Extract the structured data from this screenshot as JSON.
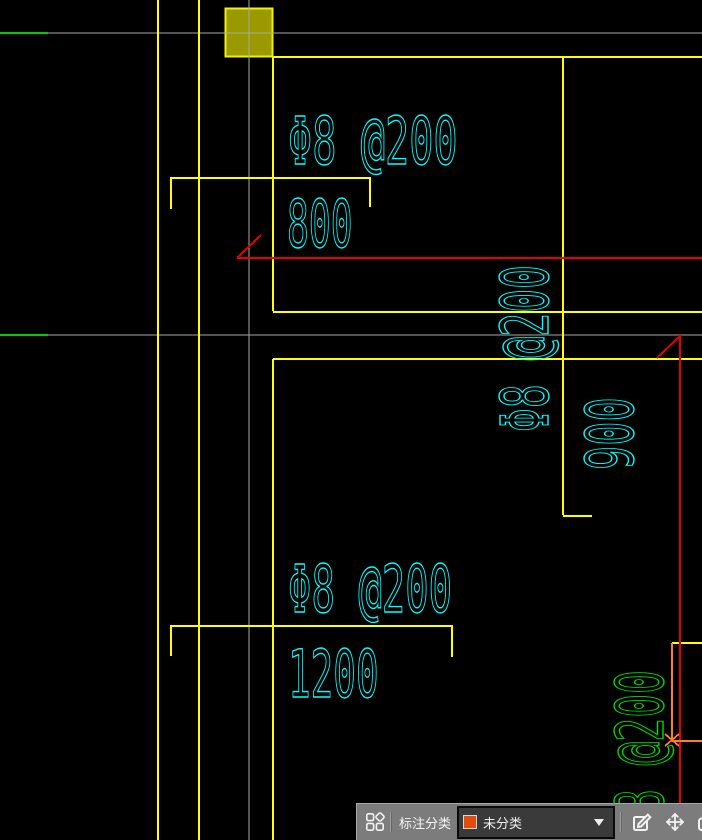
{
  "drawing": {
    "annotations": {
      "top_spacing": "Φ8 @200",
      "top_length": "800",
      "right_spacing_vertical": "Φ8 @200",
      "right_length_vertical": "900",
      "bottom_spacing": "Φ8 @200",
      "bottom_length": "1200",
      "corner_spacing_vertical": "Φ8 @200"
    },
    "colors": {
      "annotation_cyan": "#00ffff",
      "annotation_green": "#00dd00",
      "axis_gray": "#a8a8a8",
      "rebar_yellow": "#ffff00",
      "dimension_red": "#e60000",
      "dimension_orange": "#ff7f27",
      "column_fill_olive": "#9a9a00",
      "column_border_yellow": "#f2f200"
    }
  },
  "toolbar": {
    "label": "标注分类",
    "dropdown": {
      "selected": "未分类",
      "swatch_color": "#e14d0d",
      "swatch_style": "background-color:#e14d0d;"
    },
    "icon_names": {
      "categories": "category-grid-icon",
      "edit": "edit-annotation-icon",
      "move": "move-icon",
      "copy": "copy-icon",
      "arrow": "dropdown-arrow-icon"
    }
  }
}
